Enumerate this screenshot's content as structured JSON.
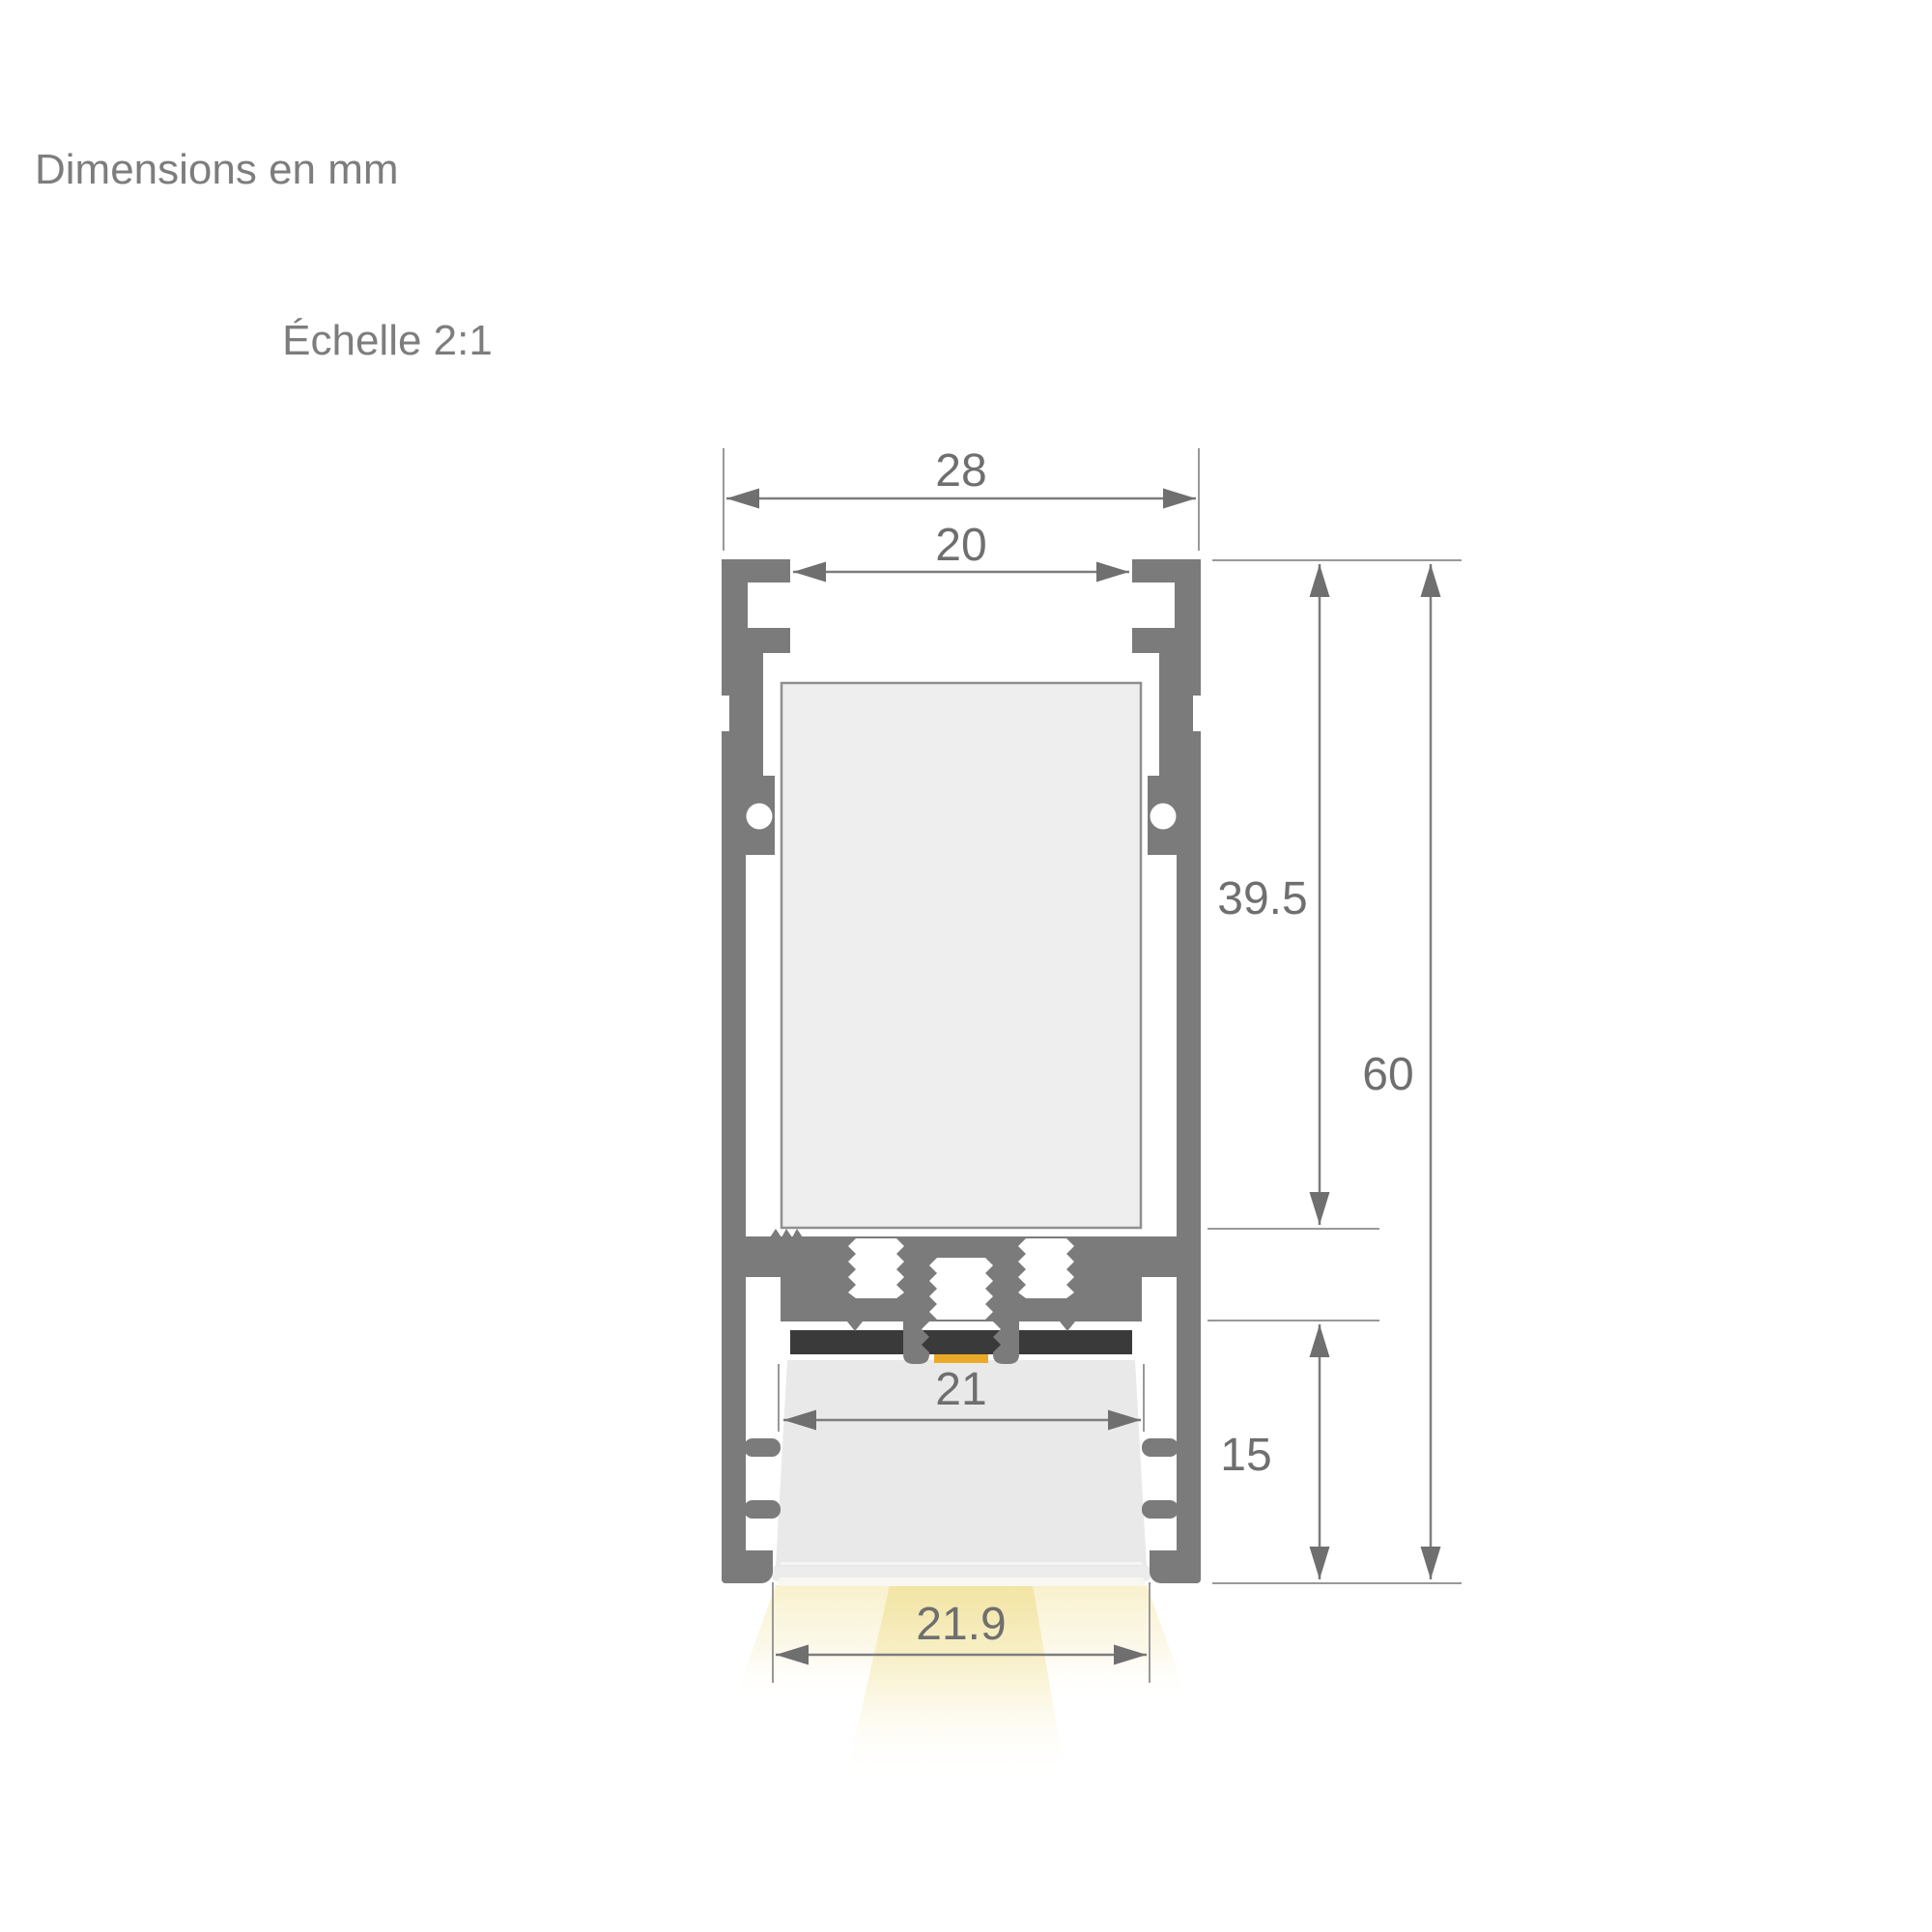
{
  "header": {
    "title": "Dimensions en mm",
    "scale": "Échelle 2:1"
  },
  "dimensions": {
    "outer_width": "28",
    "top_opening_width": "20",
    "upper_body_height": "39.5",
    "total_height": "60",
    "lower_section_height": "15",
    "diffuser_width": "21",
    "light_opening_width": "21.9"
  },
  "colors": {
    "background": "#ffffff",
    "profile_gray": "#7b7b7b",
    "cavity_fill": "#eeeeee",
    "cavity_border": "#8f8f8f",
    "pcb_dark": "#3a3a3a",
    "led_amber": "#eaaa28",
    "lens_gray": "#e9e9e9",
    "lens_base_gray": "#ececec",
    "dimension_ink": "#6f6f6f",
    "dimension_line": "#7d7d7d",
    "extension_line": "#999999",
    "title_text": "#7d7d7d"
  }
}
